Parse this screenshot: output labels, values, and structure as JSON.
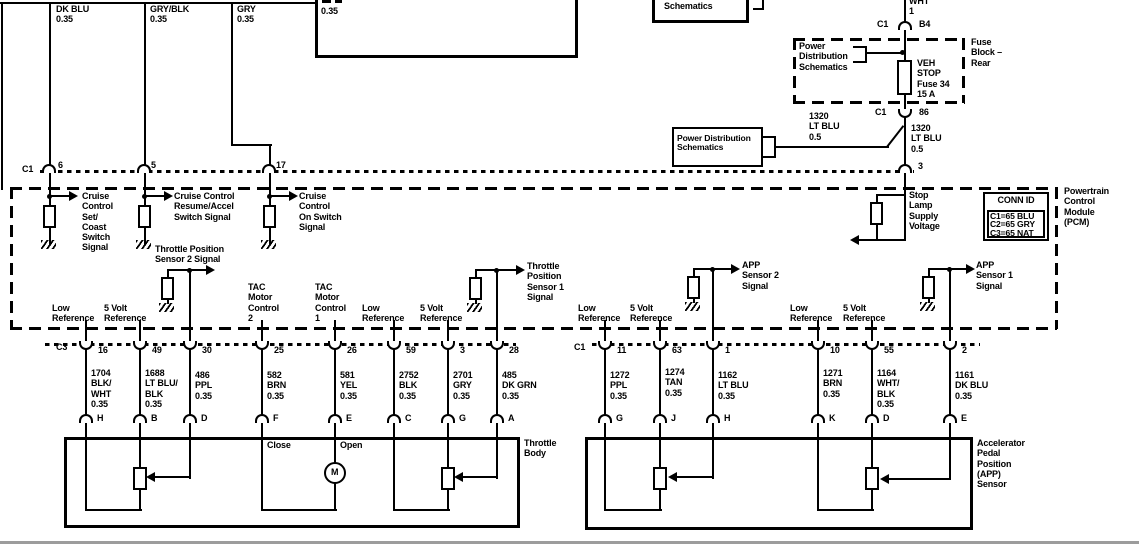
{
  "top": {
    "connector_label": "C1",
    "wires": [
      {
        "label": "DK BLU\n0.35",
        "pin": "6"
      },
      {
        "label": "GRY/BLK\n0.35",
        "pin": "5"
      },
      {
        "label": "GRY\n0.35",
        "pin": "17"
      }
    ],
    "clipped_box_label": "0.35",
    "schematics_box_label": "Schematics"
  },
  "fuse_circuit": {
    "wire_top_label": "WHT\n1",
    "connector_b4": {
      "name": "C1",
      "terminal": "B4"
    },
    "fuse_block": {
      "callout": "Power\nDistribution\nSchematics",
      "fuse_label": "VEH\nSTOP\nFuse 34\n15 A",
      "block_label": "Fuse\nBlock –\nRear"
    },
    "connector_86": {
      "name": "C1",
      "terminal": "86"
    },
    "wire_label_left": "1320\nLT BLU\n0.5",
    "wire_label_right": "1320\nLT BLU\n0.5",
    "reference_box": "Power Distribution\nSchematics",
    "pcm_pin": "3",
    "signal_label": "Stop\nLamp\nSupply\nVoltage"
  },
  "pcm": {
    "module_label": "Powertrain\nControl\nModule\n(PCM)",
    "conn_id": {
      "title": "CONN ID",
      "rows": [
        "C1=65 BLU",
        "C2=65 GRY",
        "C3=65 NAT"
      ]
    },
    "signals": {
      "cruise_set": "Cruise\nControl\nSet/\nCoast\nSwitch\nSignal",
      "cruise_resume": "Cruise Control\nResume/Accel\nSwitch Signal",
      "cruise_on": "Cruise\nControl\nOn Switch\nSignal",
      "tp2": "Throttle Position\nSensor 2 Signal",
      "tp1": "Throttle\nPosition\nSensor 1\nSignal",
      "app2": "APP\nSensor 2\nSignal",
      "app1": "APP\nSensor 1\nSignal"
    },
    "pin_functions": [
      "Low\nReference",
      "5 Volt\nReference",
      "TAC\nMotor\nControl\n2",
      "TAC\nMotor\nControl\n1",
      "Low\nReference",
      "5 Volt\nReference",
      "Low\nReference",
      "5 Volt\nReference",
      "Low\nReference",
      "5 Volt\nReference"
    ]
  },
  "left_harness": {
    "connector": "C3",
    "pins": [
      "16",
      "49",
      "30",
      "25",
      "26",
      "59",
      "3",
      "28"
    ],
    "wires": [
      "1704\nBLK/\nWHT\n0.35",
      "1688\nLT BLU/\nBLK\n0.35",
      "486\nPPL\n0.35",
      "582\nBRN\n0.35",
      "581\nYEL\n0.35",
      "2752\nBLK\n0.35",
      "2701\nGRY\n0.35",
      "485\nDK GRN\n0.35"
    ],
    "terminals": [
      "H",
      "B",
      "D",
      "F",
      "E",
      "C",
      "G",
      "A"
    ]
  },
  "right_harness": {
    "connector": "C1",
    "pins": [
      "11",
      "63",
      "1",
      "10",
      "55",
      "2"
    ],
    "wires": [
      "1272\nPPL\n0.35",
      "1274\nTAN\n0.35",
      "1162\nLT BLU\n0.35",
      "1271\nBRN\n0.35",
      "1164\nWHT/\nBLK\n0.35",
      "1161\nDK BLU\n0.35"
    ],
    "terminals": [
      "G",
      "J",
      "H",
      "K",
      "D",
      "E"
    ]
  },
  "throttle_body": {
    "name": "Throttle\nBody",
    "close_label": "Close",
    "open_label": "Open",
    "motor": "M"
  },
  "app_sensor": {
    "name": "Accelerator\nPedal\nPosition\n(APP)\nSensor"
  }
}
